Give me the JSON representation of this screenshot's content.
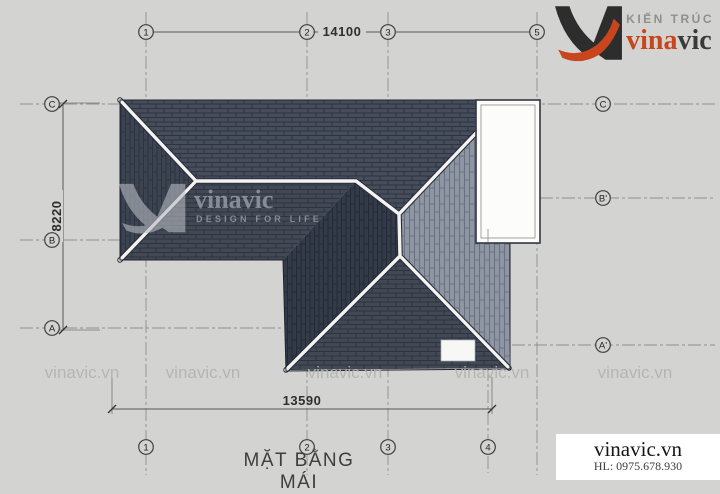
{
  "drawing": {
    "title": "MẶT BẰNG MÁI",
    "dimensions": {
      "top": "14100",
      "left": "8220",
      "bottom": "13590"
    },
    "grid": {
      "top": [
        {
          "label": "1"
        },
        {
          "label": "2"
        },
        {
          "label": "3"
        },
        {
          "label": "5"
        }
      ],
      "bottom": [
        {
          "label": "1"
        },
        {
          "label": "2"
        },
        {
          "label": "3"
        },
        {
          "label": "4"
        }
      ],
      "left": [
        {
          "label": "C"
        },
        {
          "label": "B"
        },
        {
          "label": "A"
        }
      ],
      "right": [
        {
          "label": "C"
        },
        {
          "label": "B'"
        },
        {
          "label": "A'"
        }
      ]
    }
  },
  "branding": {
    "logo": {
      "tagline_top": "KIẾN TRÚC",
      "name_accent": "vina",
      "name_rest": "vic"
    },
    "watermark_center": {
      "name": "vinavic",
      "tagline": "DESIGN FOR LIFE"
    },
    "watermark_tile": "vinavic.vn",
    "footer": {
      "website": "vinavic.vn",
      "hotline": "HL: 0975.678.930"
    }
  },
  "colors": {
    "background": "#d3d3d1",
    "roof_dark_1": "#464d5b",
    "roof_dark_2": "#424955",
    "roof_dark_3": "#3c4351",
    "roof_dark_4": "#333a48",
    "roof_light": "#8e95a3",
    "ridge_white": "#f4f3f1",
    "accent_orange": "#c8461d",
    "logo_dark": "#2d2d2d",
    "grid_gray": "#8f8f8d",
    "watermark_gray": "#b4b4b2"
  }
}
